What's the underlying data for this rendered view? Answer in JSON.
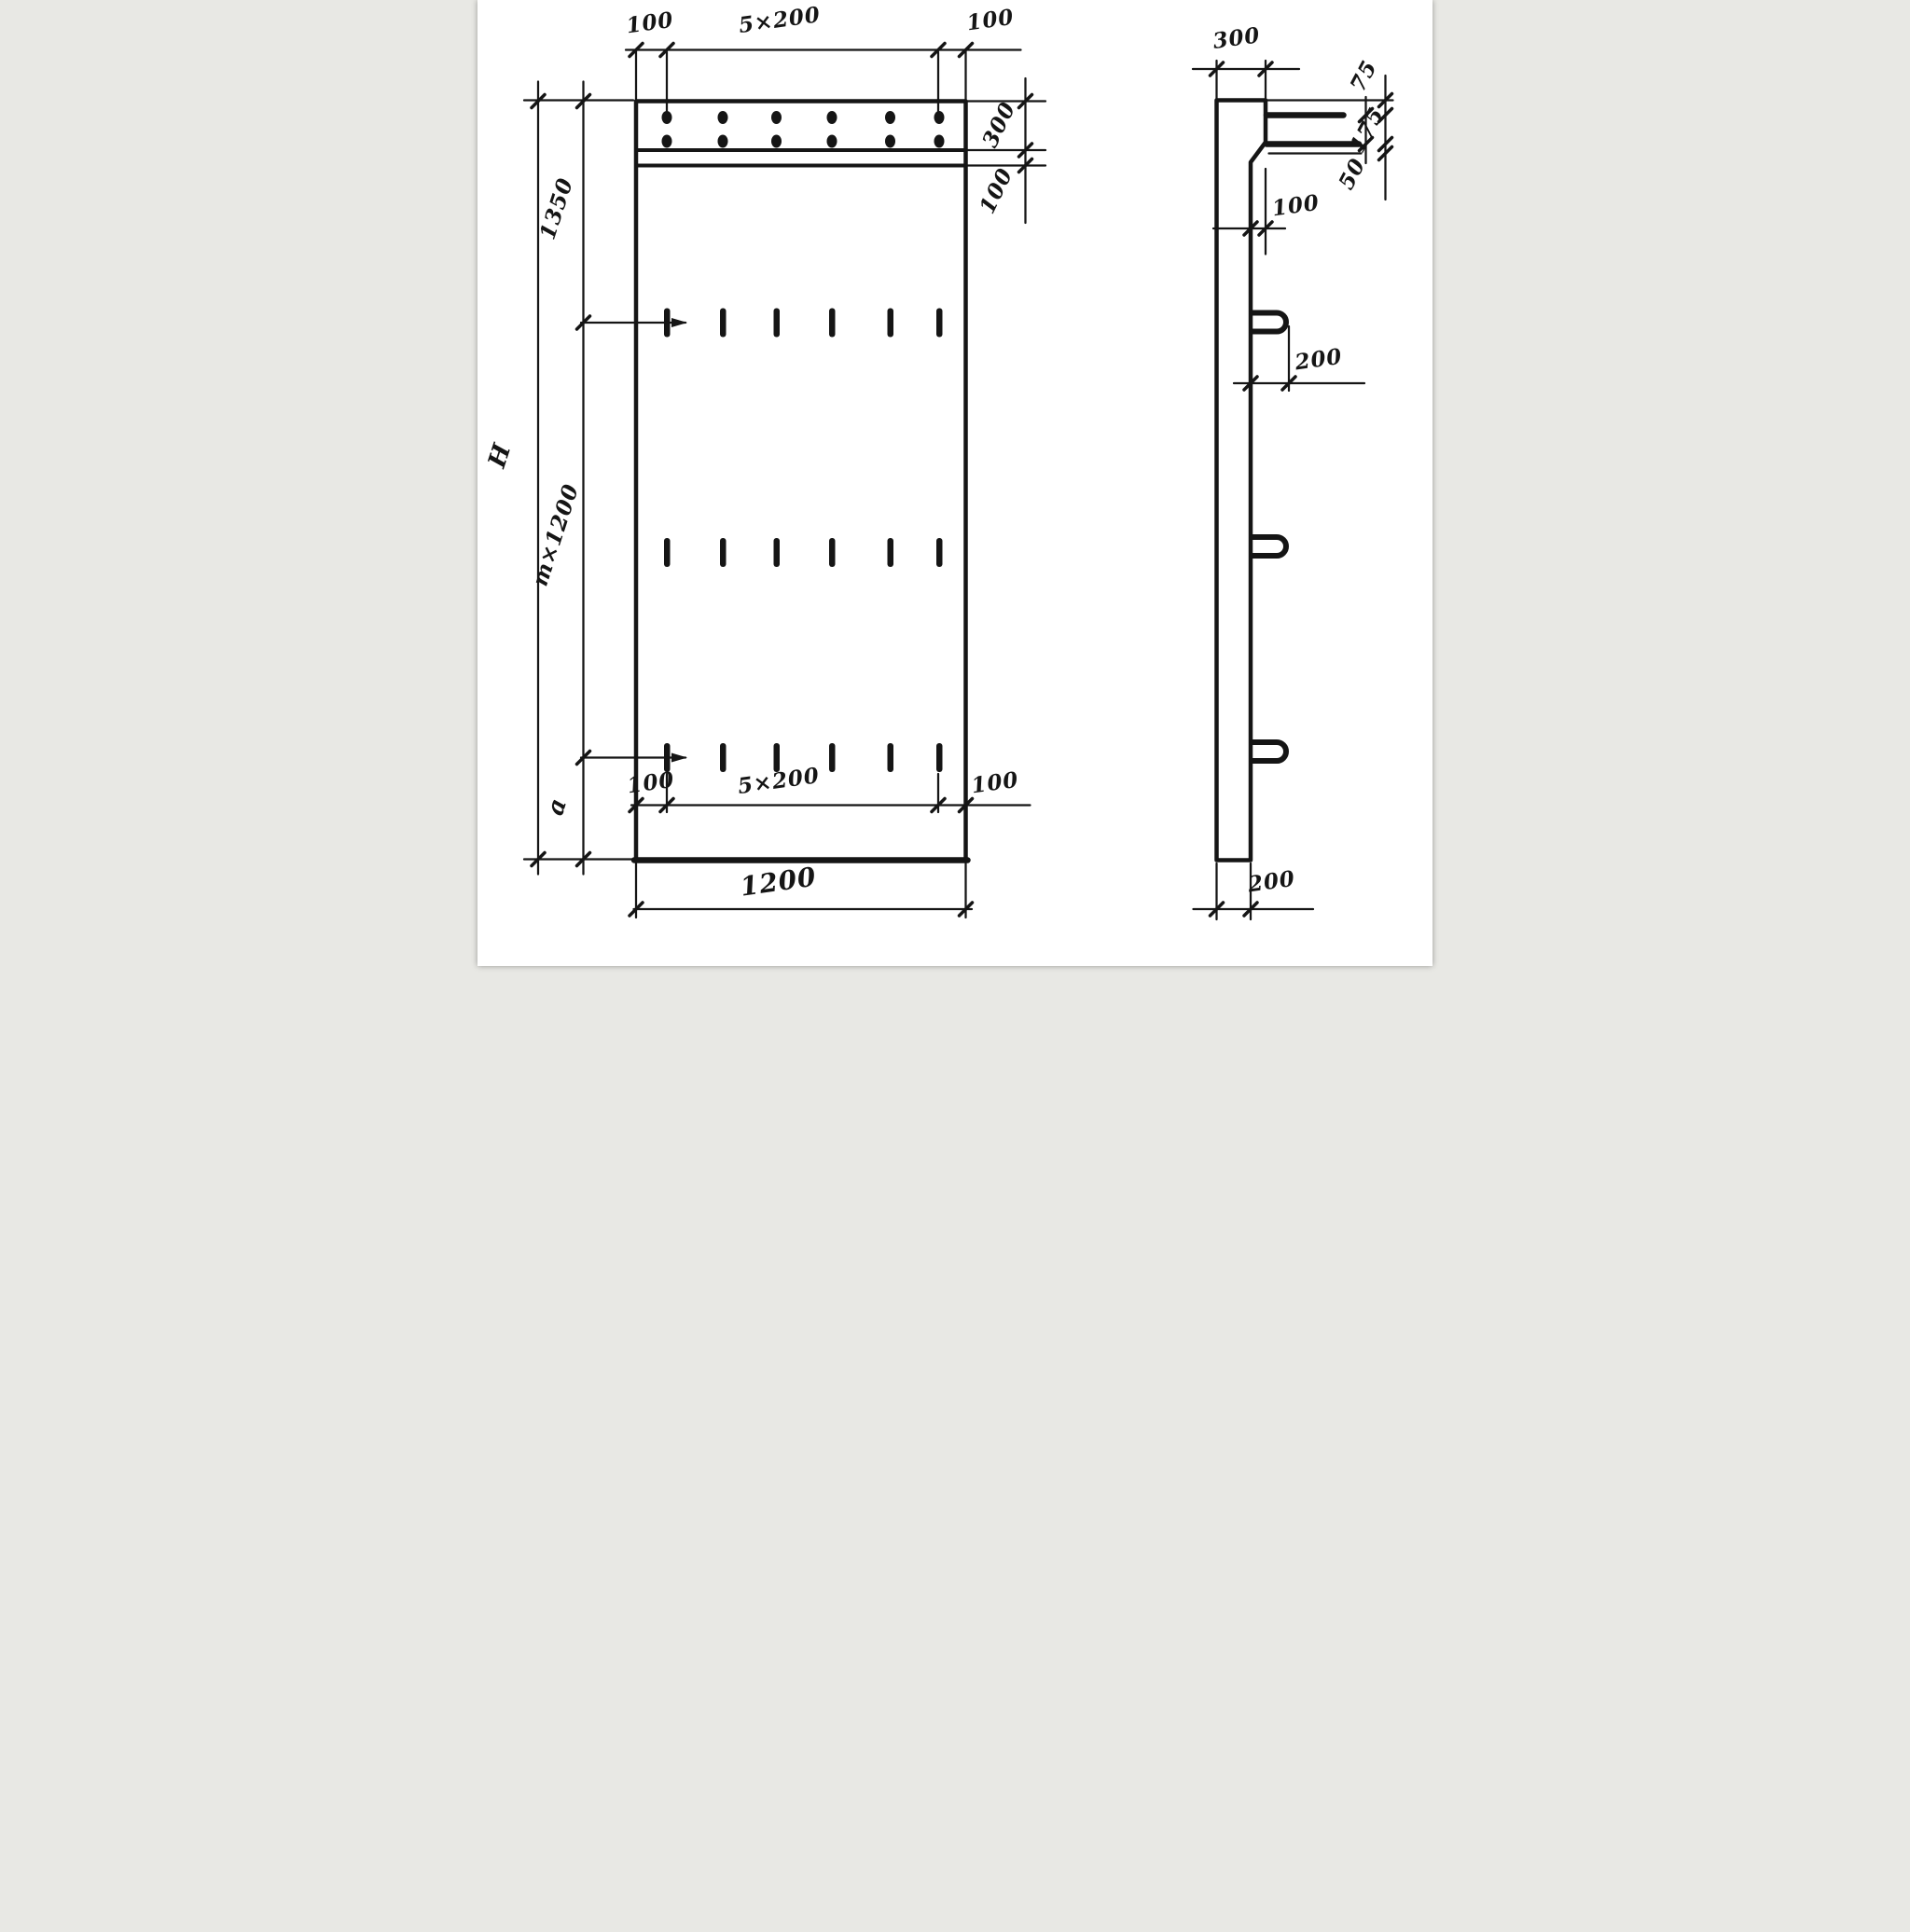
{
  "drawing": {
    "colors": {
      "ink": "#151515",
      "paper": "#ffffff"
    },
    "front_view": {
      "top_chain": {
        "left_margin": "100",
        "spacing": "5×200",
        "right_margin": "100"
      },
      "height_chain": {
        "overall": "H",
        "top_section": "1350",
        "middle_section": "m×1200",
        "bottom_section": "a"
      },
      "right_chain": {
        "cap_height": "300",
        "groove_offset": "100"
      },
      "bottom_chain": {
        "left_margin": "100",
        "spacing": "5×200",
        "right_margin": "100"
      },
      "overall_width": "1200"
    },
    "side_view": {
      "top_thickness": "300",
      "bar_chain": {
        "top_offset": "75",
        "bar_spacing": "175",
        "bottom_offset": "50"
      },
      "chamfer_offset": "100",
      "loop_projection": "200",
      "bottom_thickness": "200"
    }
  }
}
